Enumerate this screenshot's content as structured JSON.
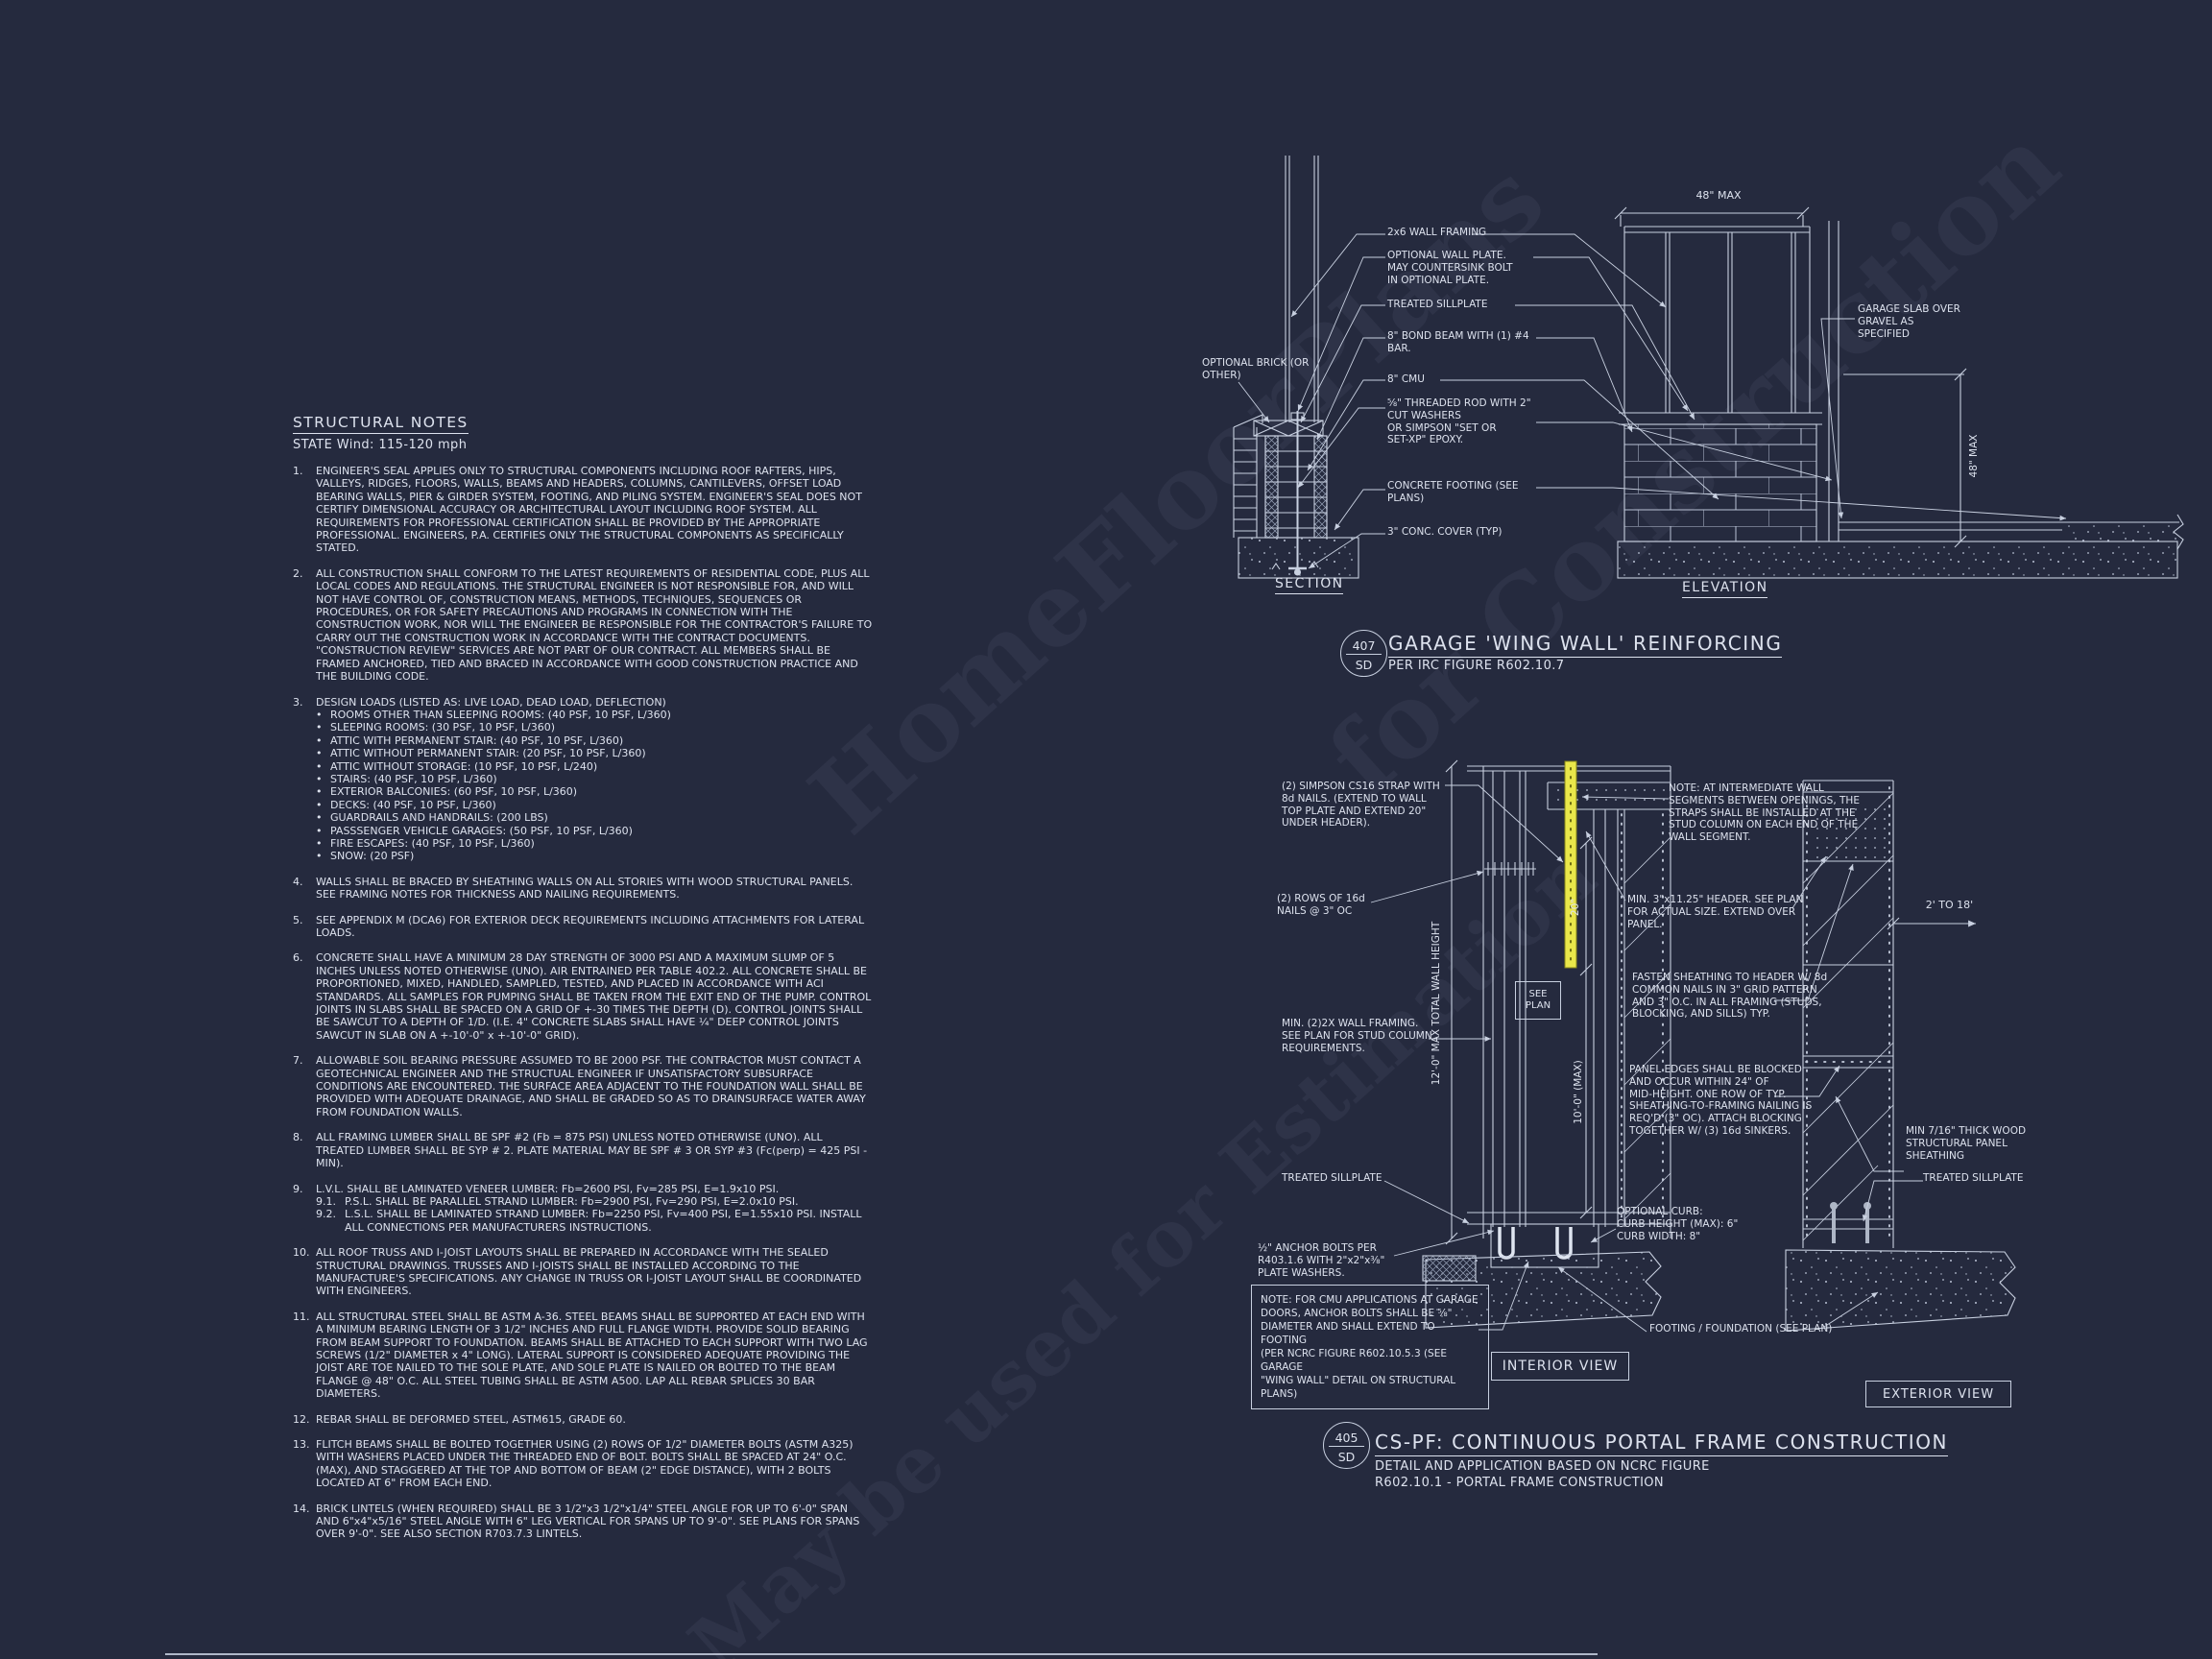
{
  "colors": {
    "background": "#252a3e",
    "line": "#c8d0e0",
    "text": "#dde2ee",
    "strap_highlight": "#e9e74a"
  },
  "watermark": {
    "lines": [
      "HomeFloorPlans",
      "for Construction",
      "May be used for Estimation"
    ]
  },
  "structural_notes": {
    "title": "STRUCTURAL NOTES",
    "subtitle": "STATE Wind: 115-120 mph",
    "notes": [
      {
        "num": "1.",
        "text": "ENGINEER'S SEAL APPLIES ONLY TO STRUCTURAL COMPONENTS INCLUDING ROOF RAFTERS, HIPS, VALLEYS, RIDGES, FLOORS, WALLS, BEAMS AND HEADERS, COLUMNS, CANTILEVERS, OFFSET LOAD BEARING WALLS, PIER & GIRDER SYSTEM, FOOTING, AND PILING SYSTEM.  ENGINEER'S SEAL DOES NOT CERTIFY DIMENSIONAL ACCURACY OR ARCHITECTURAL LAYOUT INCLUDING ROOF SYSTEM. ALL REQUIREMENTS FOR PROFESSIONAL CERTIFICATION SHALL BE PROVIDED BY THE APPROPRIATE PROFESSIONAL.  ENGINEERS, P.A. CERTIFIES ONLY THE STRUCTURAL COMPONENTS AS SPECIFICALLY STATED."
      },
      {
        "num": "2.",
        "text": "ALL CONSTRUCTION SHALL CONFORM TO THE LATEST REQUIREMENTS OF RESIDENTIAL CODE, PLUS ALL LOCAL CODES AND REGULATIONS. THE STRUCTURAL ENGINEER IS NOT RESPONSIBLE FOR, AND WILL NOT HAVE CONTROL OF, CONSTRUCTION MEANS, METHODS, TECHNIQUES, SEQUENCES OR PROCEDURES, OR FOR SAFETY PRECAUTIONS AND PROGRAMS IN CONNECTION WITH THE CONSTRUCTION WORK, NOR WILL THE ENGINEER BE RESPONSIBLE FOR THE CONTRACTOR'S FAILURE TO CARRY OUT THE CONSTRUCTION WORK IN ACCORDANCE WITH THE CONTRACT DOCUMENTS. \"CONSTRUCTION REVIEW\" SERVICES ARE NOT PART OF OUR CONTRACT. ALL MEMBERS SHALL BE FRAMED ANCHORED, TIED AND BRACED IN ACCORDANCE WITH GOOD CONSTRUCTION PRACTICE AND THE BUILDING CODE."
      },
      {
        "num": "3.",
        "text": "DESIGN LOADS (LISTED AS: LIVE LOAD, DEAD LOAD, DEFLECTION)",
        "bullets": [
          "ROOMS OTHER THAN SLEEPING ROOMS: (40 PSF, 10 PSF, L/360)",
          "SLEEPING ROOMS: (30 PSF, 10 PSF, L/360)",
          "ATTIC WITH PERMANENT STAIR: (40 PSF, 10 PSF, L/360)",
          "ATTIC WITHOUT PERMANENT STAIR: (20 PSF, 10 PSF, L/360)",
          "ATTIC WITHOUT STORAGE: (10 PSF, 10 PSF, L/240)",
          "STAIRS: (40 PSF, 10 PSF, L/360)",
          "EXTERIOR BALCONIES: (60 PSF, 10 PSF, L/360)",
          "DECKS: (40 PSF, 10 PSF, L/360)",
          "GUARDRAILS AND HANDRAILS: (200 LBS)",
          "PASSSENGER VEHICLE GARAGES: (50 PSF, 10 PSF, L/360)",
          "FIRE ESCAPES: (40 PSF, 10 PSF, L/360)",
          "SNOW: (20 PSF)"
        ]
      },
      {
        "num": "4.",
        "text": "WALLS SHALL BE BRACED BY SHEATHING WALLS ON ALL STORIES WITH WOOD STRUCTURAL PANELS. SEE FRAMING NOTES FOR THICKNESS AND NAILING REQUIREMENTS."
      },
      {
        "num": "5.",
        "text": "SEE APPENDIX M (DCA6) FOR EXTERIOR DECK REQUIREMENTS INCLUDING ATTACHMENTS FOR LATERAL LOADS."
      },
      {
        "num": "6.",
        "text": "CONCRETE SHALL HAVE A MINIMUM 28 DAY STRENGTH OF 3000 PSI AND A MAXIMUM SLUMP OF 5 INCHES UNLESS NOTED OTHERWISE (UNO). AIR ENTRAINED PER TABLE 402.2. ALL CONCRETE SHALL BE PROPORTIONED, MIXED, HANDLED, SAMPLED, TESTED, AND PLACED IN ACCORDANCE WITH ACI STANDARDS. ALL SAMPLES FOR PUMPING SHALL BE TAKEN FROM THE EXIT END OF THE PUMP. CONTROL JOINTS IN SLABS SHALL BE SPACED ON A GRID OF +-30 TIMES THE DEPTH (D). CONTROL JOINTS SHALL BE SAWCUT TO A DEPTH OF 1/D. (I.E. 4\" CONCRETE SLABS SHALL HAVE ¼\" DEEP CONTROL JOINTS SAWCUT IN SLAB ON A +-10'-0\" x +-10'-0\" GRID)."
      },
      {
        "num": "7.",
        "text": "ALLOWABLE SOIL BEARING PRESSURE ASSUMED TO BE 2000 PSF. THE CONTRACTOR MUST CONTACT A GEOTECHNICAL ENGINEER AND THE STRUCTUAL ENGINEER IF UNSATISFACTORY SUBSURFACE CONDITIONS ARE ENCOUNTERED. THE SURFACE AREA ADJACENT TO THE FOUNDATION WALL SHALL BE PROVIDED WITH ADEQUATE DRAINAGE, AND SHALL BE GRADED SO AS TO DRAINSURFACE WATER AWAY FROM FOUNDATION WALLS."
      },
      {
        "num": "8.",
        "text": "ALL FRAMING LUMBER SHALL BE SPF #2 (Fb = 875 PSI) UNLESS NOTED OTHERWISE (UNO). ALL TREATED LUMBER SHALL BE SYP # 2. PLATE MATERIAL MAY BE SPF # 3 OR SYP #3 (Fc(perp) = 425 PSI - MIN)."
      },
      {
        "num": "9.",
        "text": "L.V.L.  SHALL BE LAMINATED VENEER LUMBER: Fb=2600 PSI, Fv=285 PSI, E=1.9x10  PSI.",
        "subitems": [
          {
            "num": "9.1.",
            "text": "P.S.L.  SHALL BE PARALLEL STRAND LUMBER: Fb=2900 PSI, Fv=290 PSI, E=2.0x10  PSI."
          },
          {
            "num": "9.2.",
            "text": "L.S.L.  SHALL BE LAMINATED STRAND LUMBER: Fb=2250 PSI, Fv=400 PSI, E=1.55x10  PSI. INSTALL ALL CONNECTIONS PER MANUFACTURERS INSTRUCTIONS."
          }
        ]
      },
      {
        "num": "10.",
        "text": "ALL ROOF TRUSS AND I-JOIST LAYOUTS SHALL BE PREPARED IN ACCORDANCE WITH THE SEALED STRUCTURAL DRAWINGS. TRUSSES AND I-JOISTS SHALL BE INSTALLED ACCORDING TO THE MANUFACTURE'S SPECIFICATIONS. ANY CHANGE IN TRUSS OR I-JOIST LAYOUT SHALL BE COORDINATED WITH  ENGINEERS."
      },
      {
        "num": "11.",
        "text": "ALL STRUCTURAL STEEL SHALL BE ASTM A-36. STEEL BEAMS SHALL BE SUPPORTED AT EACH END WITH A MINIMUM BEARING LENGTH OF 3 1/2\" INCHES AND FULL FLANGE WIDTH. PROVIDE SOLID BEARING FROM BEAM SUPPORT TO FOUNDATION.  BEAMS SHALL BE ATTACHED TO EACH SUPPORT WITH TWO LAG SCREWS (1/2\" DIAMETER x 4\" LONG). LATERAL SUPPORT IS CONSIDERED ADEQUATE PROVIDING THE JOIST ARE TOE NAILED TO THE SOLE PLATE, AND SOLE PLATE IS NAILED OR BOLTED TO THE BEAM FLANGE @ 48\" O.C. ALL STEEL TUBING SHALL BE ASTM A500. LAP ALL REBAR SPLICES 30 BAR DIAMETERS."
      },
      {
        "num": "12.",
        "text": "REBAR SHALL BE DEFORMED STEEL, ASTM615, GRADE 60."
      },
      {
        "num": "13.",
        "text": "FLITCH BEAMS SHALL BE BOLTED TOGETHER USING (2) ROWS OF 1/2\" DIAMETER BOLTS (ASTM A325) WITH WASHERS PLACED UNDER THE THREADED END OF BOLT. BOLTS SHALL BE SPACED AT 24\" O.C. (MAX), AND STAGGERED AT THE TOP AND BOTTOM OF BEAM (2\" EDGE DISTANCE), WITH 2 BOLTS LOCATED AT 6\" FROM EACH END."
      },
      {
        "num": "14.",
        "text": "BRICK LINTELS (WHEN REQUIRED) SHALL BE 3 1/2\"x3 1/2\"x1/4\" STEEL ANGLE FOR UP TO 6'-0\" SPAN AND 6\"x4\"x5/16\" STEEL ANGLE WITH 6\" LEG VERTICAL FOR SPANS UP TO 9'-0\". SEE PLANS FOR SPANS OVER 9'-0\". SEE ALSO SECTION R703.7.3 LINTELS."
      }
    ]
  },
  "wing_wall": {
    "bubble": {
      "number": "407",
      "sheet": "SD"
    },
    "title": "GARAGE 'WING WALL' REINFORCING",
    "subtitle": "PER IRC FIGURE R602.10.7",
    "section_label": "SECTION",
    "elevation_label": "ELEVATION",
    "dims": {
      "top": "48\" MAX",
      "right": "48\" MAX"
    },
    "callouts": {
      "optional_brick": "OPTIONAL BRICK (OR\nOTHER)",
      "wall_framing": "2x6 WALL FRAMING",
      "optional_plate": "OPTIONAL WALL PLATE.\nMAY COUNTERSINK BOLT\nIN OPTIONAL PLATE.",
      "sillplate": "TREATED SILLPLATE",
      "bond_beam": "8\" BOND BEAM WITH (1) #4\nBAR.",
      "cmu": "8\" CMU",
      "threaded_rod": "⅝\" THREADED ROD WITH 2\"\nCUT WASHERS\nOR SIMPSON \"SET OR\nSET-XP\" EPOXY.",
      "footing": "CONCRETE FOOTING (SEE\nPLANS)",
      "conc_cover": "3\" CONC. COVER (TYP)",
      "slab": "GARAGE SLAB OVER\nGRAVEL AS\nSPECIFIED"
    }
  },
  "portal_frame": {
    "bubble": {
      "number": "405",
      "sheet": "SD"
    },
    "title": "CS-PF: CONTINUOUS PORTAL FRAME CONSTRUCTION",
    "subtitle": "DETAIL AND APPLICATION BASED ON NCRC FIGURE\nR602.10.1 - PORTAL FRAME CONSTRUCTION",
    "view_labels": {
      "interior": "INTERIOR VIEW",
      "exterior": "EXTERIOR VIEW"
    },
    "dims": {
      "wall_height": "12'-0\" MAX TOTAL WALL HEIGHT",
      "opening_height": "10'-0\" (MAX)",
      "strap_extend": "20\"",
      "opening_span": "2' TO 18'",
      "see_plan": "SEE\nPLAN"
    },
    "callouts": {
      "strap": "(2) SIMPSON CS16 STRAP WITH\n8d NAILS. (EXTEND TO WALL\nTOP PLATE AND EXTEND 20\"\nUNDER HEADER).",
      "nails": "(2) ROWS OF 16d\nNAILS @ 3\" OC",
      "framing": "MIN. (2)2X WALL FRAMING.\nSEE PLAN FOR STUD COLUMN\nREQUIREMENTS.",
      "sill_left": "TREATED SILLPLATE",
      "anchor": "½\" ANCHOR BOLTS PER\nR403.1.6 WITH 2\"x2\"x⅜\"\nPLATE WASHERS.",
      "cmu_note": "NOTE: FOR CMU APPLICATIONS AT GARAGE\nDOORS, ANCHOR BOLTS SHALL BE ⅝\"\nDIAMETER AND SHALL EXTEND TO FOOTING\n(PER NCRC FIGURE R602.10.5.3 (SEE GARAGE\n\"WING WALL\" DETAIL ON STRUCTURAL PLANS)",
      "intermediate": "NOTE: AT INTERMEDIATE WALL\nSEGMENTS BETWEEN OPENINGS, THE\nSTRAPS SHALL BE INSTALLED AT THE\nSTUD COLUMN ON EACH END OF THE\nWALL SEGMENT.",
      "header": "MIN. 3\"x11.25\" HEADER. SEE PLAN\nFOR ACTUAL SIZE. EXTEND OVER\nPANEL.",
      "fasten": "FASTEN SHEATHING TO HEADER W/ 8d\nCOMMON NAILS IN 3\" GRID PATTERN\nAND 3\" O.C. IN ALL FRAMING (STUDS,\nBLOCKING, AND SILLS) TYP.",
      "panel_edges": "PANEL EDGES SHALL BE BLOCKED\nAND OCCUR WITHIN 24\" OF\nMID-HEIGHT.  ONE ROW OF TYP.\nSHEATHING-TO-FRAMING NAILING IS\nREQ'D (3\" OC).  ATTACH BLOCKING\nTOGETHER W/ (3) 16d SINKERS.",
      "sheathing": "MIN 7/16\" THICK WOOD\nSTRUCTURAL PANEL\nSHEATHING",
      "sill_right": "TREATED SILLPLATE",
      "curb": "OPTIONAL CURB:\nCURB HEIGHT (MAX): 6\"\nCURB WIDTH: 8\"",
      "footing": "FOOTING / FOUNDATION (SEE PLAN)"
    }
  }
}
